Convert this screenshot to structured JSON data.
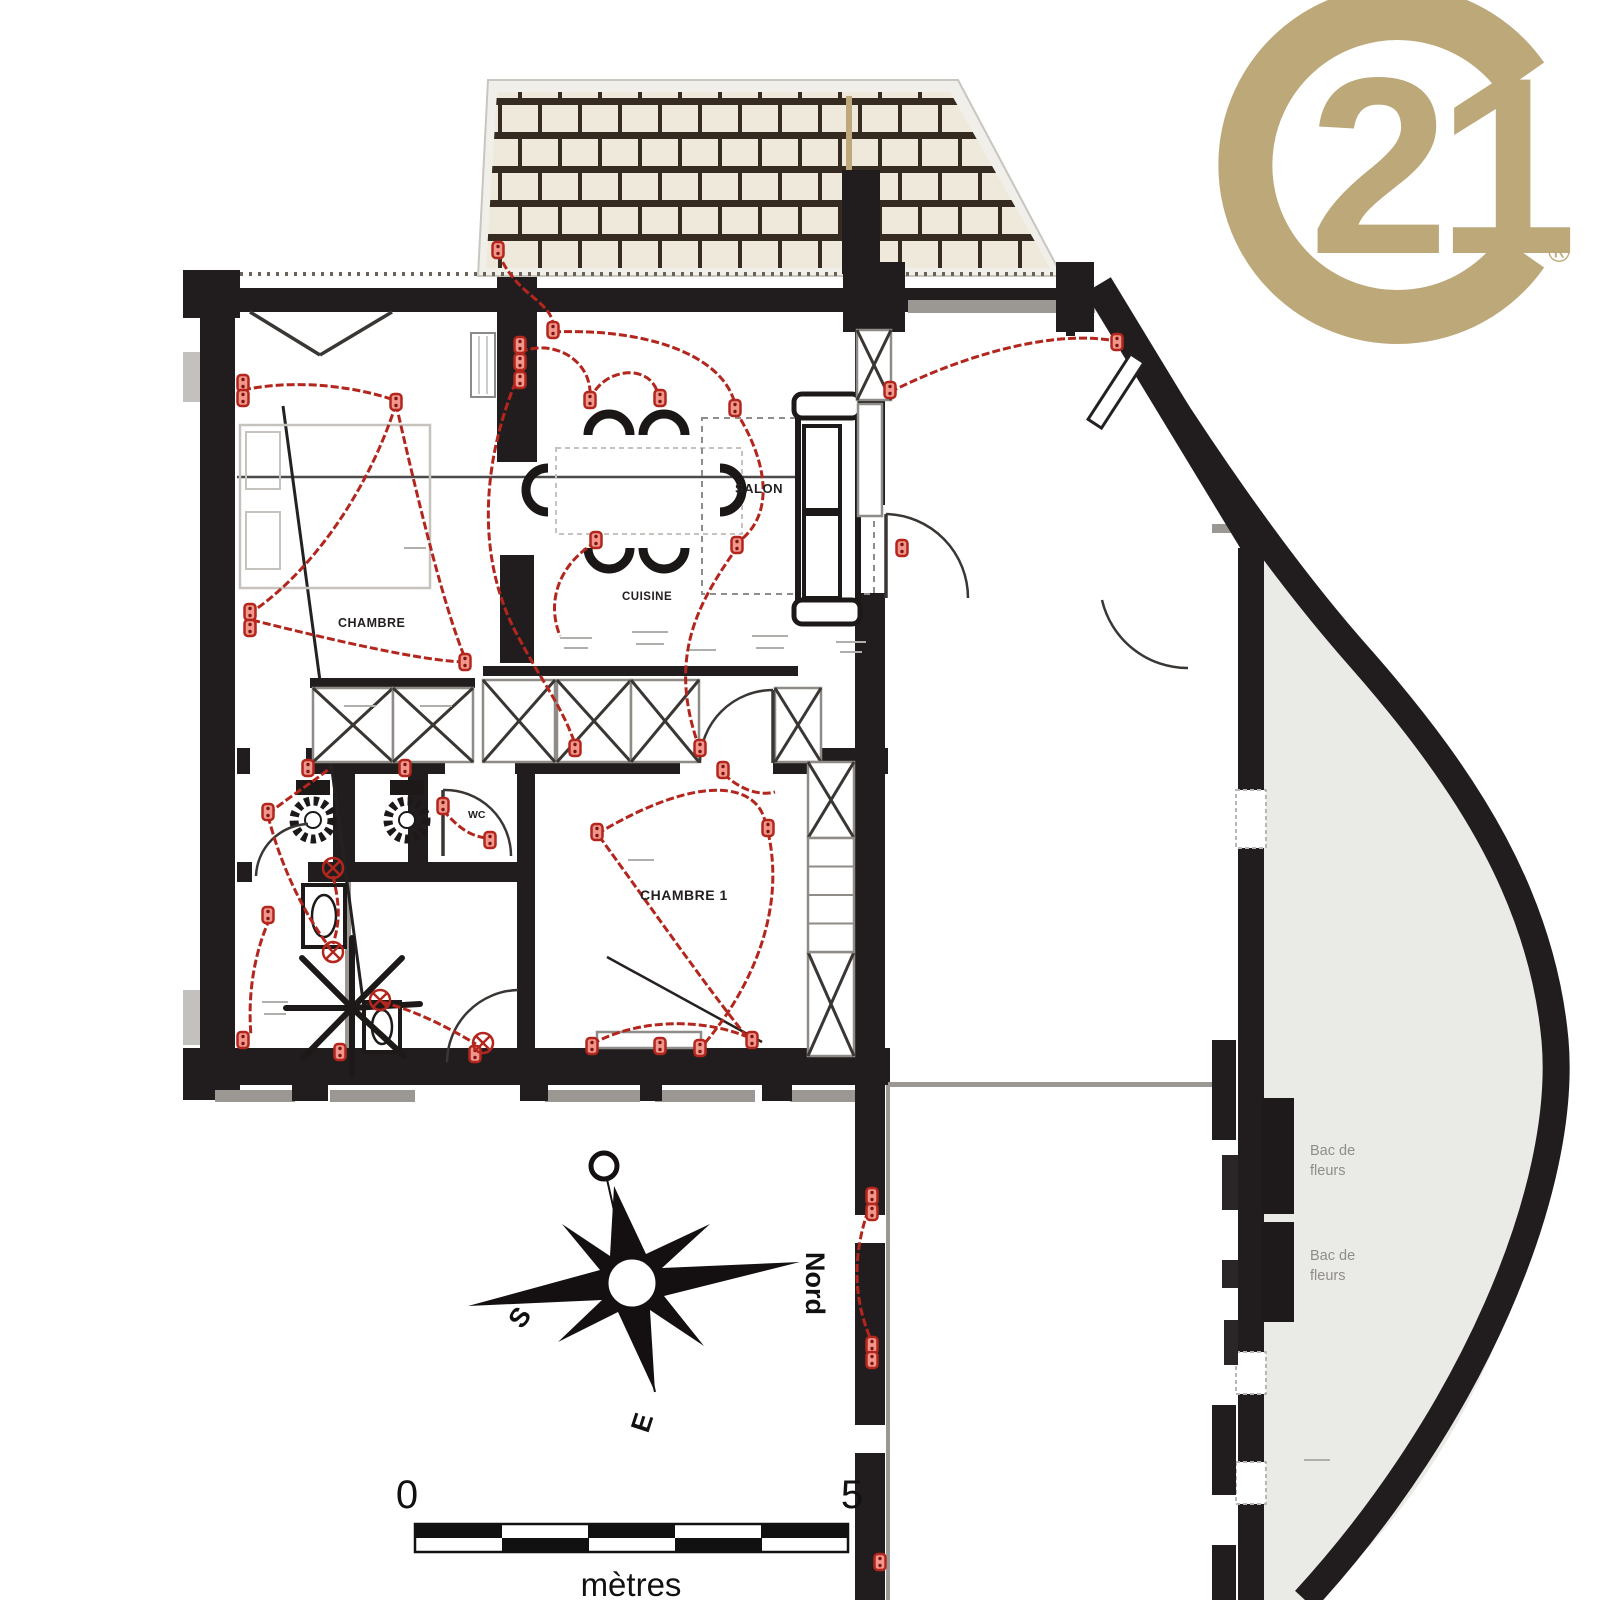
{
  "branding": {
    "logo_number": "21",
    "registered_mark": "®"
  },
  "room_labels": {
    "salon": "SALON",
    "cuisine": "CUISINE",
    "chambre": "CHAMBRE",
    "chambre1": "CHAMBRE 1",
    "wc": "WC"
  },
  "compass": {
    "north": "Nord",
    "south": "S",
    "east": "E"
  },
  "scale_bar": {
    "start": "0",
    "end": "5",
    "unit": "mètres"
  },
  "terrace": {
    "planter_line1": "Bac de",
    "planter_line2": "fleurs"
  },
  "colors": {
    "gold": "#BCA878",
    "wall": "#211D1E",
    "electric_red": "#B3261E",
    "outlet_fill": "#F0968A",
    "tile_fill": "#EFE9DB",
    "tile_grout": "#362B20",
    "terrace_fill": "#EAEAE7",
    "line_gray": "#9B9894"
  },
  "floorplan": {
    "outlets": [
      [
        243,
        383
      ],
      [
        243,
        398
      ],
      [
        250,
        612
      ],
      [
        250,
        628
      ],
      [
        396,
        402
      ],
      [
        465,
        662
      ],
      [
        520,
        345
      ],
      [
        520,
        362
      ],
      [
        520,
        380
      ],
      [
        553,
        330
      ],
      [
        590,
        400
      ],
      [
        660,
        398
      ],
      [
        735,
        408
      ],
      [
        737,
        545
      ],
      [
        596,
        540
      ],
      [
        575,
        748
      ],
      [
        700,
        748
      ],
      [
        723,
        770
      ],
      [
        498,
        250
      ],
      [
        890,
        390
      ],
      [
        902,
        548
      ],
      [
        1117,
        342
      ],
      [
        268,
        812
      ],
      [
        268,
        915
      ],
      [
        243,
        1040
      ],
      [
        308,
        768
      ],
      [
        405,
        768
      ],
      [
        443,
        806
      ],
      [
        490,
        840
      ],
      [
        597,
        832
      ],
      [
        768,
        828
      ],
      [
        700,
        1048
      ],
      [
        752,
        1040
      ],
      [
        660,
        1046
      ],
      [
        592,
        1046
      ],
      [
        475,
        1054
      ],
      [
        340,
        1052
      ],
      [
        872,
        1196
      ],
      [
        872,
        1212
      ],
      [
        872,
        1345
      ],
      [
        872,
        1360
      ],
      [
        880,
        1562
      ]
    ],
    "ceiling_lights": [
      [
        333,
        868
      ],
      [
        333,
        952
      ],
      [
        380,
        1000
      ],
      [
        483,
        1043
      ]
    ],
    "wires": [
      "M 498 252 C 515 295 550 300 553 324",
      "M 243 390 C 300 378 360 388 394 400",
      "M 396 404 C 372 480 320 565 252 612",
      "M 252 620 C 340 642 420 660 462 662",
      "M 396 404 C 420 510 445 610 465 658",
      "M 520 352 C 556 338 592 362 590 396",
      "M 590 400 C 602 368 650 362 658 394",
      "M 520 372 C 484 452 472 556 520 640 C 542 682 562 706 575 744",
      "M 553 332 C 640 328 722 352 735 404",
      "M 735 410 C 772 468 772 518 738 542",
      "M 738 546 C 702 598 666 652 698 744",
      "M 596 542 C 562 562 545 598 560 636",
      "M 268 814 C 296 792 316 780 330 768",
      "M 268 816 C 280 862 300 908 330 948",
      "M 270 918 C 252 958 248 1000 251 1036",
      "M 333 876 C 340 906 340 922 333 944",
      "M 382 1002 C 420 1012 452 1030 476 1044",
      "M 890 392 C 950 362 1040 330 1110 340",
      "M 597 834 C 700 772 760 782 766 826",
      "M 768 832 C 788 920 742 1000 704 1044",
      "M 599 836 C 660 920 716 1000 748 1038",
      "M 872 1200 C 852 1250 852 1298 872 1342",
      "M 592 1044 C 640 1018 704 1018 750 1038",
      "M 443 810 C 460 830 472 836 486 838",
      "M 724 774 C 740 790 760 796 775 792"
    ]
  }
}
